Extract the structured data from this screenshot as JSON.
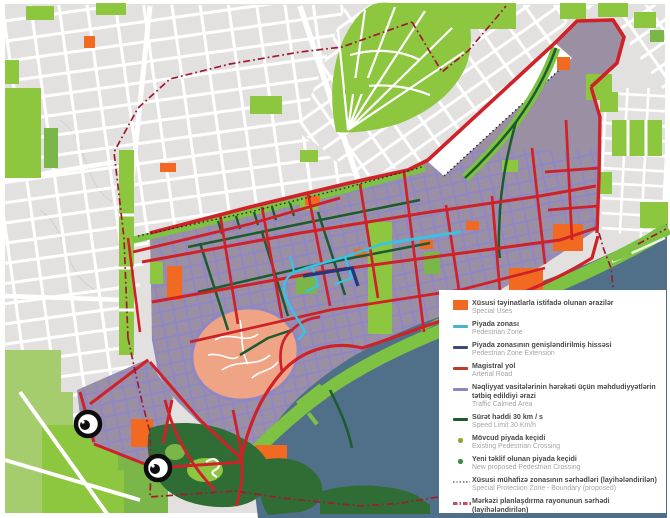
{
  "map": {
    "watermark_glyph": "©",
    "watermark_count": 2,
    "colors": {
      "base": "#e2e1df",
      "street": "#ffffff",
      "park": "#8dc63f",
      "park_mid": "#7ab648",
      "park_pale": "#a6cd6d",
      "park_dark": "#2f6d35",
      "district": "#9b8fa4",
      "inner_street": "#8e86c9",
      "arterial": "#cf2127",
      "speed30": "#1c5b2d",
      "pedestrian": "#35c4e8",
      "pedestrian_ext": "#27357e",
      "special_use": "#f26a21",
      "old_city": "#efa585",
      "sea": "#50708a",
      "boulevard": "#7dc242",
      "boundary_central": "#9e1b32",
      "boundary_special": "#2a2a2a"
    }
  },
  "legend": {
    "items": [
      {
        "label_az": "Xüsusi təyinatlarla istifadə olunan ərazilər",
        "label_en": "Special Uses",
        "symbol": "rect",
        "color": "#f26a21"
      },
      {
        "label_az": "Piyada zonası",
        "label_en": "Pedestrian Zone",
        "symbol": "line",
        "color": "#4ab5c4"
      },
      {
        "label_az": "Piyada zonasının genişləndirilmiş hissəsi",
        "label_en": "Pedestrian Zone Extension",
        "symbol": "line",
        "color": "#3d4a77"
      },
      {
        "label_az": "Magistral yol",
        "label_en": "Arterial Road",
        "symbol": "line",
        "color": "#c0392b"
      },
      {
        "label_az": "Nəqliyyat vasitələrinin hərəkəti üçün məhdudiyyətlərin tətbiq edildiyi ərazi",
        "label_en": "Traffic Calmed Area",
        "symbol": "line",
        "color": "#8d85c0"
      },
      {
        "label_az": "Sürət həddi 30 km / s",
        "label_en": "Speed Limit 30 Km/h",
        "symbol": "line",
        "color": "#1c5b2d"
      },
      {
        "label_az": "Mövcud piyada keçidi",
        "label_en": "Existing Pedestrian Crossing",
        "symbol": "dot",
        "color": "#97a139"
      },
      {
        "label_az": "Yeni təklif olunan piyada keçidi",
        "label_en": "New proposed Pedestrian Crossing",
        "symbol": "dot",
        "color": "#3e8e41"
      },
      {
        "label_az": "Xüsusi mühafizə zonasının sərhədləri (layihələndirilən)",
        "label_en": "Special Protection Zone - Boundary (proposed)",
        "symbol": "dotted",
        "color": "#8a8a8a"
      },
      {
        "label_az": "Mərkəzi planlaşdırma rayonunun sərhədi (layihələndirilən)",
        "label_en": "Central Planning District- Protection Boundary (proposed)",
        "symbol": "dashdot",
        "color": "#c14e5e"
      }
    ]
  }
}
